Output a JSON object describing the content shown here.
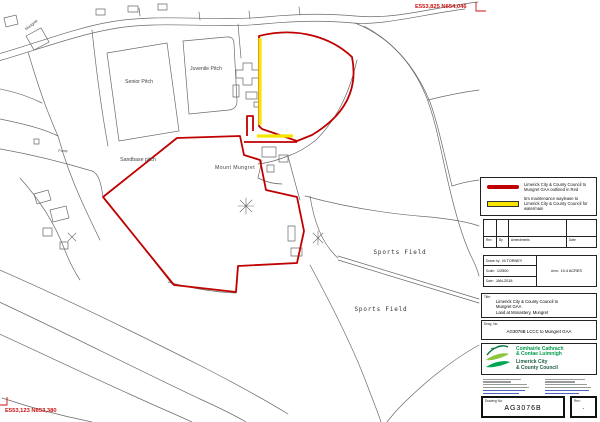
{
  "map": {
    "labels": {
      "senior_pitch": "Senior Pitch",
      "juvenile_pitch": "Juvenile Pitch",
      "sandbase_pitch": "Sandbase pitch",
      "mount_mungret": "Mount Mungret",
      "pump": "Pump",
      "sports_field_upper": "Sports Field",
      "sports_field_lower": "Sports Field",
      "mungret": "Mungret"
    },
    "coordinates": {
      "top_right": "E553,825 N654,046",
      "bottom_left": "E553,123 N653,380"
    },
    "colors": {
      "boundary_red": "#c00000",
      "waylease_yellow": "#f5e500",
      "linework_grey": "#6a6a6a",
      "coordinate_red": "#cc1111"
    }
  },
  "legend": {
    "items": [
      {
        "swatch": "red-line",
        "label": "Limerick City & County Council to Mungret GAA outlined in Red"
      },
      {
        "swatch": "yellow-strip",
        "label": "5m maintenance waylease to Limerick City & County Council for watermain"
      }
    ]
  },
  "revision_table": {
    "headers": [
      "Rev",
      "By",
      "Amendments",
      "Date"
    ]
  },
  "drawing_info": {
    "drawn_by_label": "Drawn by:",
    "drawn_by": "M.TORNEY",
    "scale_label": "Scale:",
    "scale": "1/2500",
    "area_label": "Area:",
    "area": "10.4 ACRES",
    "date_label": "Date:",
    "date": "JAN-2018"
  },
  "title_block": {
    "label": "Title:",
    "line1": "Limerick City & County Council to",
    "line2": "Mungret GAA",
    "line3": "Land at Monastery, Mungret"
  },
  "drwg_no_block": {
    "label": "Drwg. No:",
    "value": "AG3076B LCCC to Mungret GAA"
  },
  "logo": {
    "irish_line1": "Comhairle Cathrach",
    "irish_line2": "& Contae Luimnigh",
    "english_line1": "Limerick City",
    "english_line2": "& County Council",
    "green": "#009a49",
    "dark_green": "#1d5c3f"
  },
  "drawing_number": {
    "label": "Drawing No:",
    "value": "AG3076B"
  },
  "rev_box": {
    "label": "Rev:",
    "value": "-"
  }
}
